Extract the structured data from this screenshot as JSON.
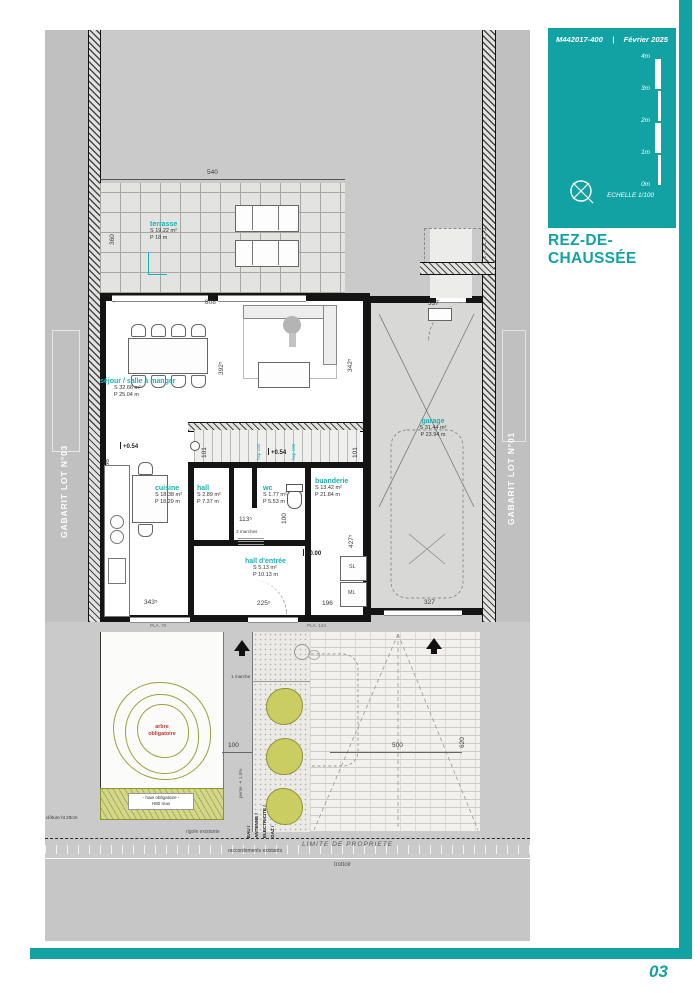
{
  "colors": {
    "accent": "#12a2a4",
    "room_label": "#19b1b3",
    "red": "#c03a2e",
    "olive": "#9aa23a"
  },
  "title_block": {
    "doc_number": "M442017-400",
    "separator": "|",
    "date": "Février 2025",
    "scale_label": "ECHELLE  1/100",
    "scale_ticks": [
      "4m",
      "3m",
      "2m",
      "1m",
      "0m"
    ],
    "compass_icon": "compass-circle-cross"
  },
  "drawing_title": "REZ-DE-CHAUSSÉE",
  "page": {
    "number": "03"
  },
  "gabarit": {
    "left": "GABARIT LOT N°03",
    "right": "GABARIT LOT N°01"
  },
  "rooms": {
    "terrasse": {
      "name": "terrasse",
      "s": "S  19.22 m²",
      "p": "P  18 m"
    },
    "sejour": {
      "name": "séjour / salle à manger",
      "s": "S  32.66 m²",
      "p": "P  25.04 m"
    },
    "cuisine": {
      "name": "cuisine",
      "s": "S  18.38 m²",
      "p": "P  18.29 m"
    },
    "hall": {
      "name": "hall",
      "s": "S  2.89 m²",
      "p": "P  7.37 m"
    },
    "wc": {
      "name": "wc",
      "s": "S  1.77 m²",
      "p": "P  5.53 m"
    },
    "buanderie": {
      "name": "buanderie",
      "s": "S  13.42 m²",
      "p": "P  21.84 m"
    },
    "hall_entree": {
      "name": "hall d'entrée",
      "s": "S  5.13 m²",
      "p": "P  10.13 m"
    },
    "garage": {
      "name": "garage",
      "s": "S  31.44 m²",
      "p": "P  23.94 m"
    }
  },
  "levels": {
    "terrace": "+0.54",
    "stair": "+0.54",
    "entry": "+0.00"
  },
  "dimensions": {
    "d540": "540",
    "d360": "360",
    "d808": "808",
    "d337": "337",
    "d392": "392⁵",
    "d342": "342⁵",
    "d956": "956",
    "d101a": "101",
    "d101b": "101",
    "d146": "146",
    "d113": "113⁵",
    "d100wc": "100",
    "d427": "427⁵",
    "d343": "343⁵",
    "d225": "225⁵",
    "d196": "196",
    "d327": "327",
    "d500": "500",
    "d620": "620",
    "d100path": "100"
  },
  "annotations": {
    "marches3": "3 marches",
    "marche1": "1 marche",
    "sl": "SL",
    "ml": "ML",
    "pla70": "PLA. 70",
    "pla144": "PLA. 144",
    "hsp1": "hsp 180",
    "hsp2": "hsp 180",
    "arbre1": "arbre",
    "arbre2": "obligatoire",
    "haie1": "- haie obligatoire -",
    "haie2": "H80 max",
    "cloture": "clôture ht  20cm",
    "pente": "pente ± 1.5%",
    "rigole": "rigole existante",
    "raccord": "raccordements existants",
    "limite": "LIMITE DE PROPRIETE",
    "trottoir": "trottoir",
    "eau": "EAU /",
    "antenne": "ANTENNE /",
    "elec": "ELECTRICITE /",
    "gaz": "GAZ /"
  }
}
